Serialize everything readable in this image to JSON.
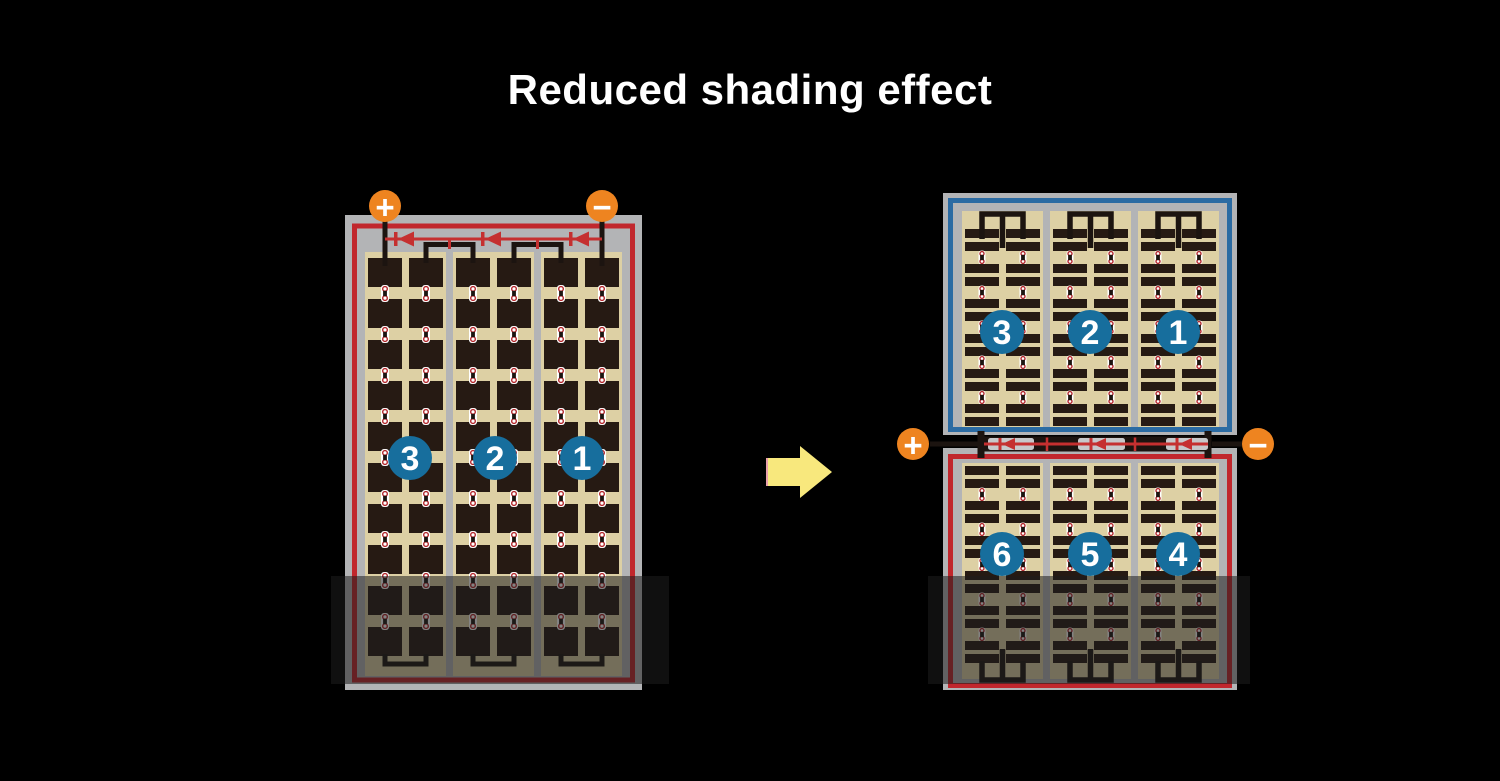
{
  "title": "Reduced shading effect",
  "left_panel": {
    "terminal_positive": "+",
    "terminal_negative": "−",
    "string_numbers": [
      "3",
      "2",
      "1"
    ]
  },
  "right_panels": {
    "terminal_positive": "+",
    "terminal_negative": "−",
    "top_string_numbers": [
      "3",
      "2",
      "1"
    ],
    "bottom_string_numbers": [
      "6",
      "5",
      "4"
    ]
  },
  "structure": {
    "left": {
      "cell_rows": 10,
      "column_groups": 3,
      "columns_per_group": 2,
      "diodes": 3,
      "shaded_cell_rows": 2
    },
    "right_top": {
      "bar_pairs": 6,
      "column_groups": 3,
      "columns_per_group": 2
    },
    "right_bottom": {
      "bar_pairs": 6,
      "column_groups": 3,
      "columns_per_group": 2
    },
    "junction_diodes": 3
  },
  "colors": {
    "background": "#000000",
    "title": "#ffffff",
    "frame_gray": "#b3b4b6",
    "border_red": "#c1272d",
    "border_blue": "#2b6ba3",
    "cell_area_tan": "#ddd0a4",
    "cell_dark": "#261a13",
    "wire_black": "#1c1410",
    "diode_red": "#c1272d",
    "diode_line_red": "#c53030",
    "terminal_orange": "#ee8420",
    "number_circle_blue": "#176e9d",
    "arrow_yellow": "#f8e87d",
    "arrow_edge_pink": "#e9a0ac",
    "junction_gray": "#c7c8ca",
    "connector_dot_red": "#b3262a",
    "connector_white": "#ffffff",
    "shade_overlay": "rgba(30,30,30,0.55)"
  }
}
